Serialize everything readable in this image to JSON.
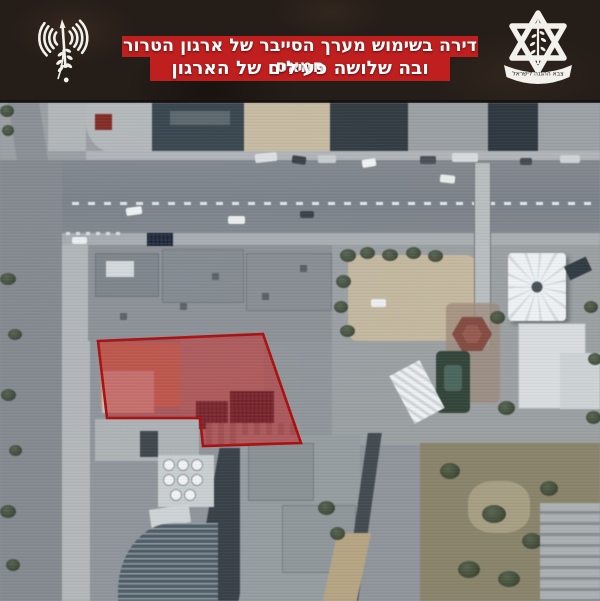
{
  "header": {
    "background_color": "#251d18",
    "banner": {
      "background_color": "#c01f1f",
      "text_color": "#ffffff",
      "line1": "דירה בשימוש מערך הסייבר של ארגון הטרור חמאס",
      "line2": "ובה שלושה פעילים של הארגון"
    },
    "left_emblem": {
      "icon_name": "radio-waves-sword-olive-branch-icon",
      "color": "#f3f1ec"
    },
    "idf_emblem": {
      "icon_name": "idf-star-of-david-sword-olive-icon",
      "ribbon_text": "צבא ההגנה לישראל",
      "color": "#f3f1ec"
    }
  },
  "satellite_photo": {
    "content_name": "aerial-view-urban-block-with-marked-building",
    "marked_building": {
      "outline_color": "#ac0d0d",
      "fill_color": "rgba(198,28,28,0.5)",
      "polygon_points": "98,238 263,231 301,340 203,343 200,315 107,315"
    }
  }
}
